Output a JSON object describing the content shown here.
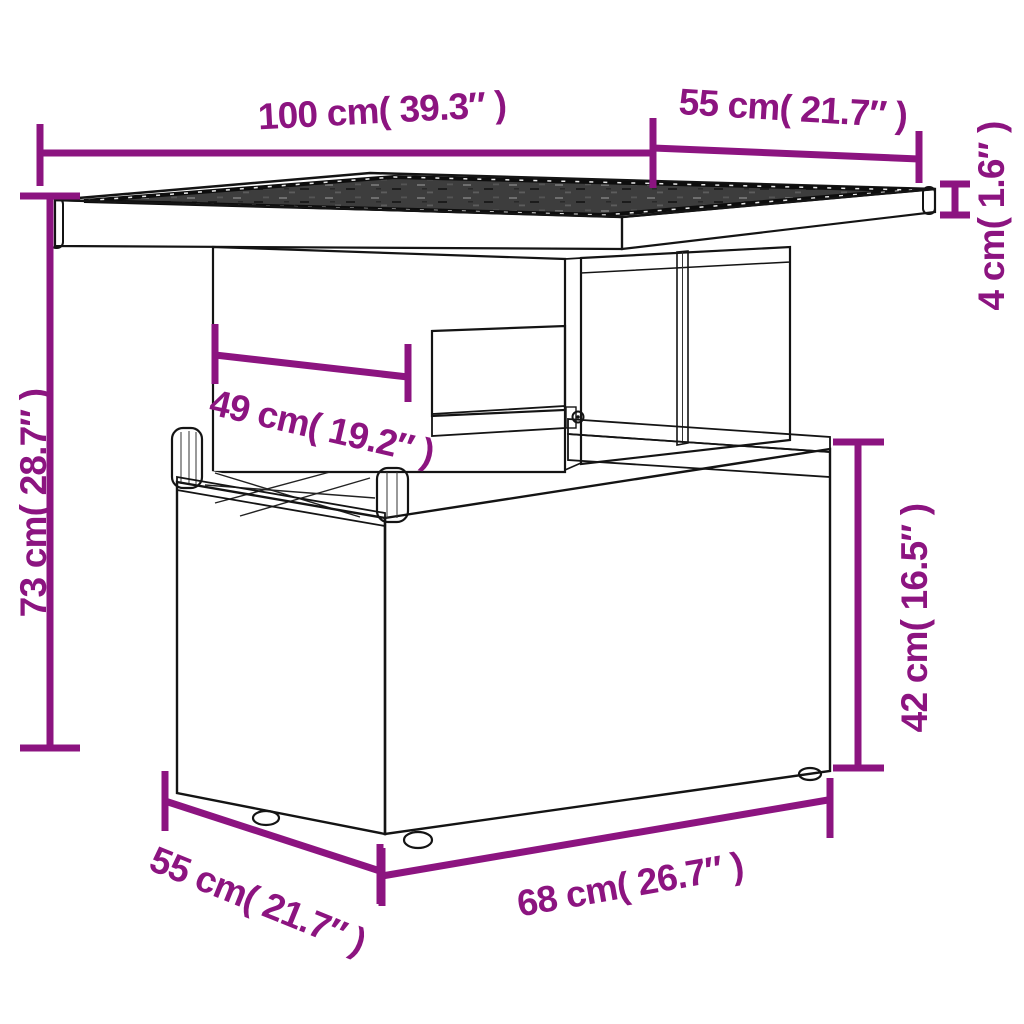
{
  "diagram": {
    "accent_color": "#8C1480",
    "outline_color": "#141414",
    "glass_color": "#3d3d3d",
    "background_color": "#ffffff",
    "product_parts": [
      "glass-tabletop",
      "pedestal-column",
      "column-window",
      "base-box",
      "feet"
    ],
    "dimensions": {
      "tabletop_length": {
        "label": "100 cm( 39.3″ )",
        "cm": 100,
        "inch": 39.3
      },
      "tabletop_depth": {
        "label": "55 cm( 21.7″ )",
        "cm": 55,
        "inch": 21.7
      },
      "glass_thickness": {
        "label": "4 cm( 1.6″ )",
        "cm": 4,
        "inch": 1.6
      },
      "total_height": {
        "label": "73 cm( 28.7″ )",
        "cm": 73,
        "inch": 28.7
      },
      "column_width": {
        "label": "49 cm( 19.2″ )",
        "cm": 49,
        "inch": 19.2
      },
      "base_height": {
        "label": "42 cm( 16.5″ )",
        "cm": 42,
        "inch": 16.5
      },
      "base_depth": {
        "label": "55 cm( 21.7″ )",
        "cm": 55,
        "inch": 21.7
      },
      "base_width": {
        "label": "68 cm( 26.7″ )",
        "cm": 68,
        "inch": 26.7
      }
    }
  }
}
